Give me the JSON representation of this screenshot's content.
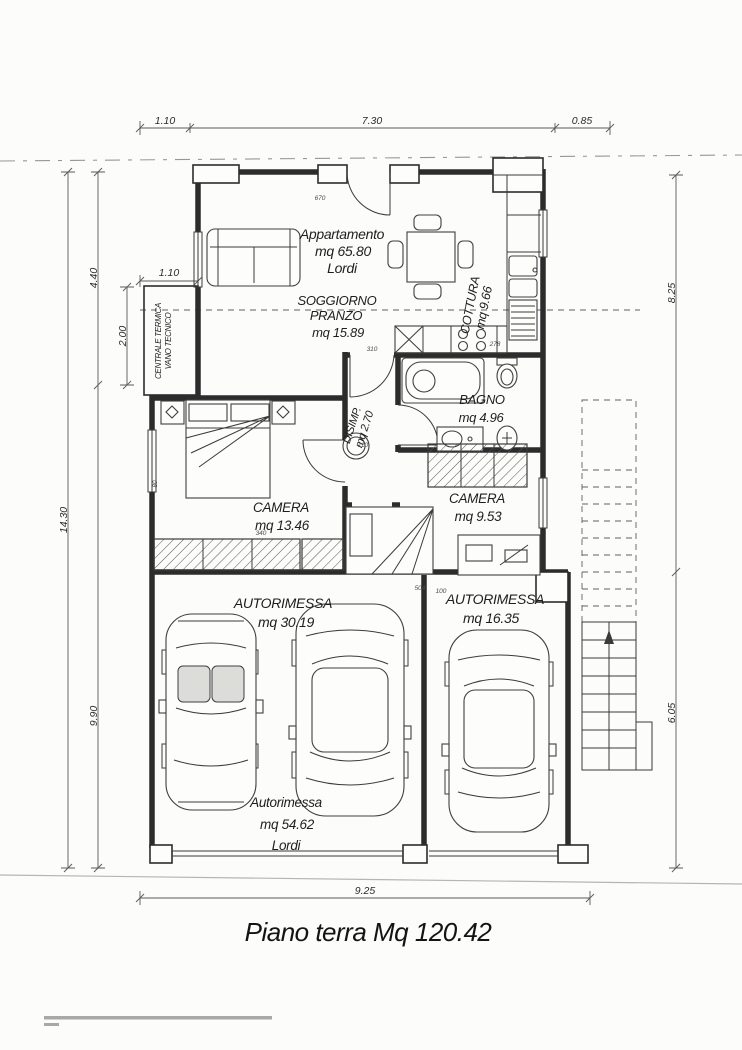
{
  "title": "Piano terra Mq 120.42",
  "dims": {
    "top": [
      "1.10",
      "7.30",
      "0.85"
    ],
    "left_outer": "14.30",
    "left_upper": "4.40",
    "left_lower": "9.90",
    "tecnico_height": "2.00",
    "tecnico_width": "1.10",
    "right_upper": "8.25",
    "right_lower": "6.05",
    "bottom": "9.25"
  },
  "rooms": {
    "apartment": {
      "l1": "Appartamento",
      "l2": "mq 65.80",
      "l3": "Lordi"
    },
    "soggiorno": {
      "l1": "SOGGIORNO",
      "l2": "PRANZO",
      "l3": "mq 15.89"
    },
    "cottura": {
      "l1": "COTTURA",
      "l2": "mq 9.66"
    },
    "centrale": {
      "l1": "CENTRALE TERMICA",
      "l2": "VANO TECNICO"
    },
    "disimpegno": {
      "l1": "DISIMP.",
      "l2": "mq 2.70"
    },
    "bagno": {
      "l1": "BAGNO",
      "l2": "mq 4.96"
    },
    "camera_grande": {
      "l1": "CAMERA",
      "l2": "mq 13.46"
    },
    "camera_piccola": {
      "l1": "CAMERA",
      "l2": "mq 9.53"
    },
    "autorimessa_sx": {
      "l1": "AUTORIMESSA",
      "l2": "mq 30.19"
    },
    "autorimessa_dx": {
      "l1": "AUTORIMESSA",
      "l2": "mq 16.35"
    },
    "autorimessa_tot": {
      "l1": "Autorimessa",
      "l2": "mq 54.62",
      "l3": "Lordi"
    }
  },
  "annotations": [
    "670",
    "310",
    "110",
    "278",
    "504",
    "100",
    "80",
    "340"
  ]
}
